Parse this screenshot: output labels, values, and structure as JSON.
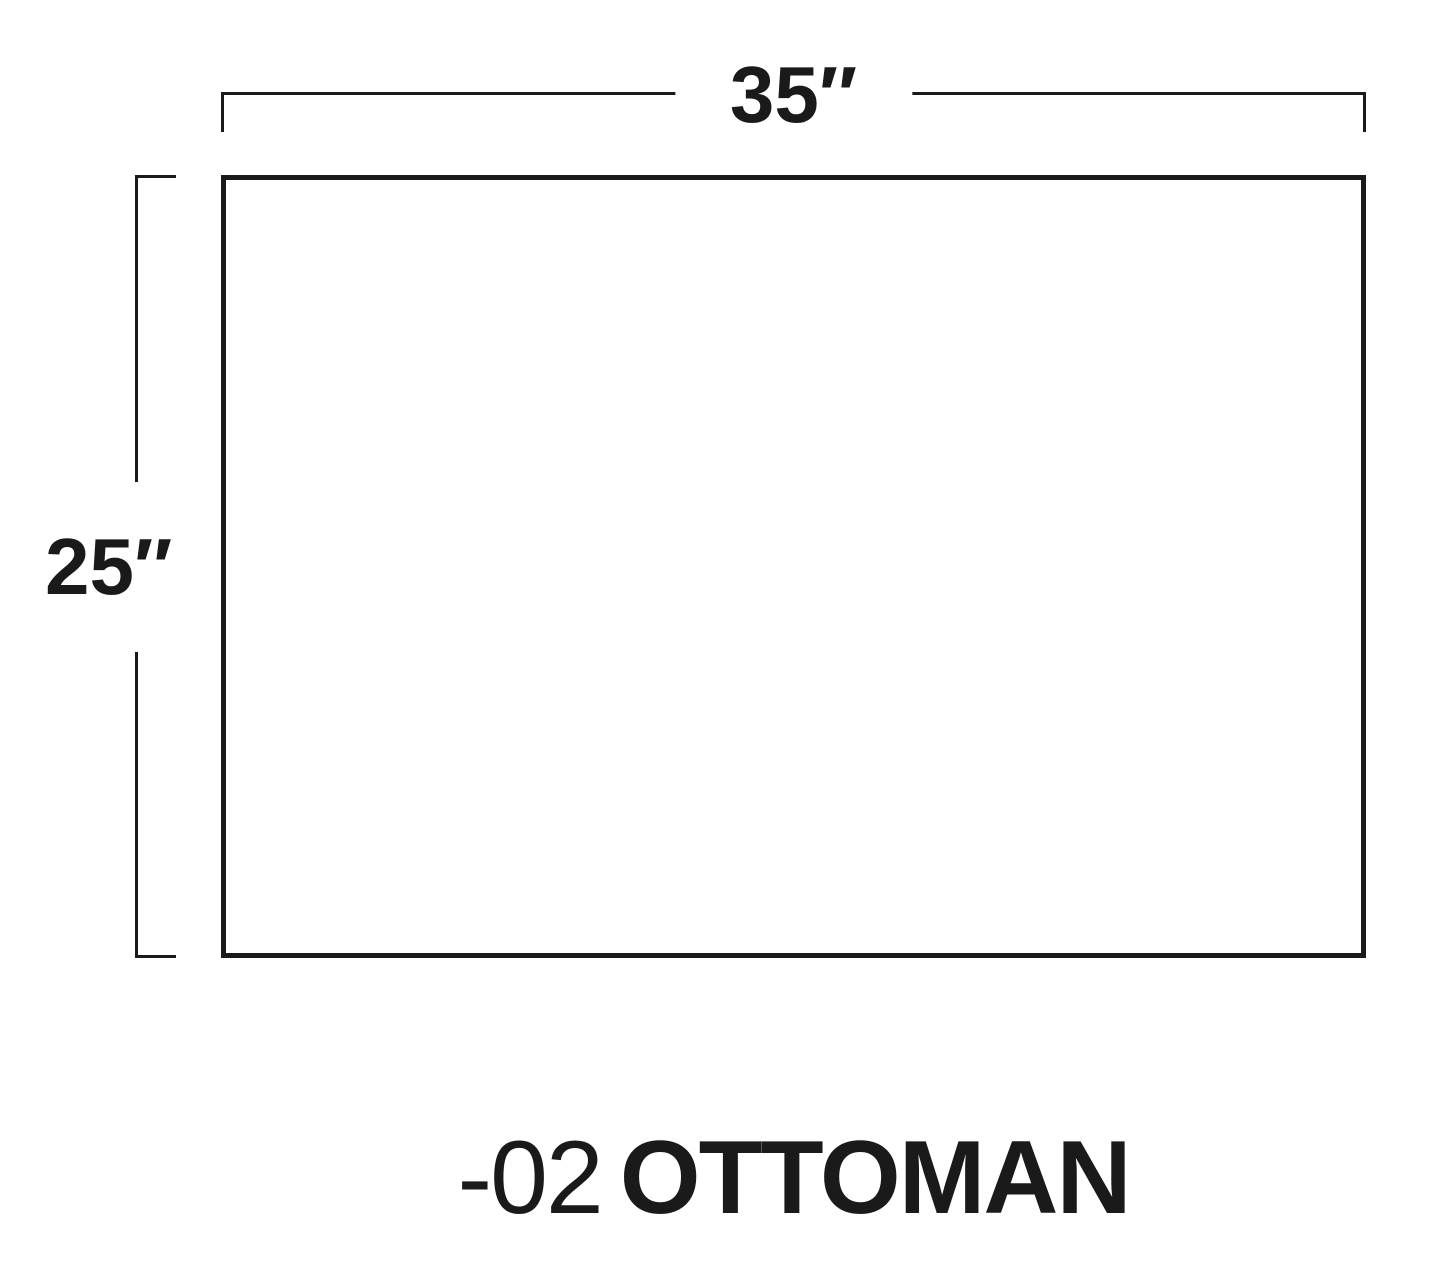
{
  "diagram": {
    "type": "furniture-dimension-diagram",
    "background_color": "#ffffff",
    "line_color": "#1a1a1a",
    "width_dimension_label": "35″",
    "height_dimension_label": "25″",
    "product_code": "-02",
    "product_name": "OTTOMAN",
    "shape": "rectangle"
  }
}
